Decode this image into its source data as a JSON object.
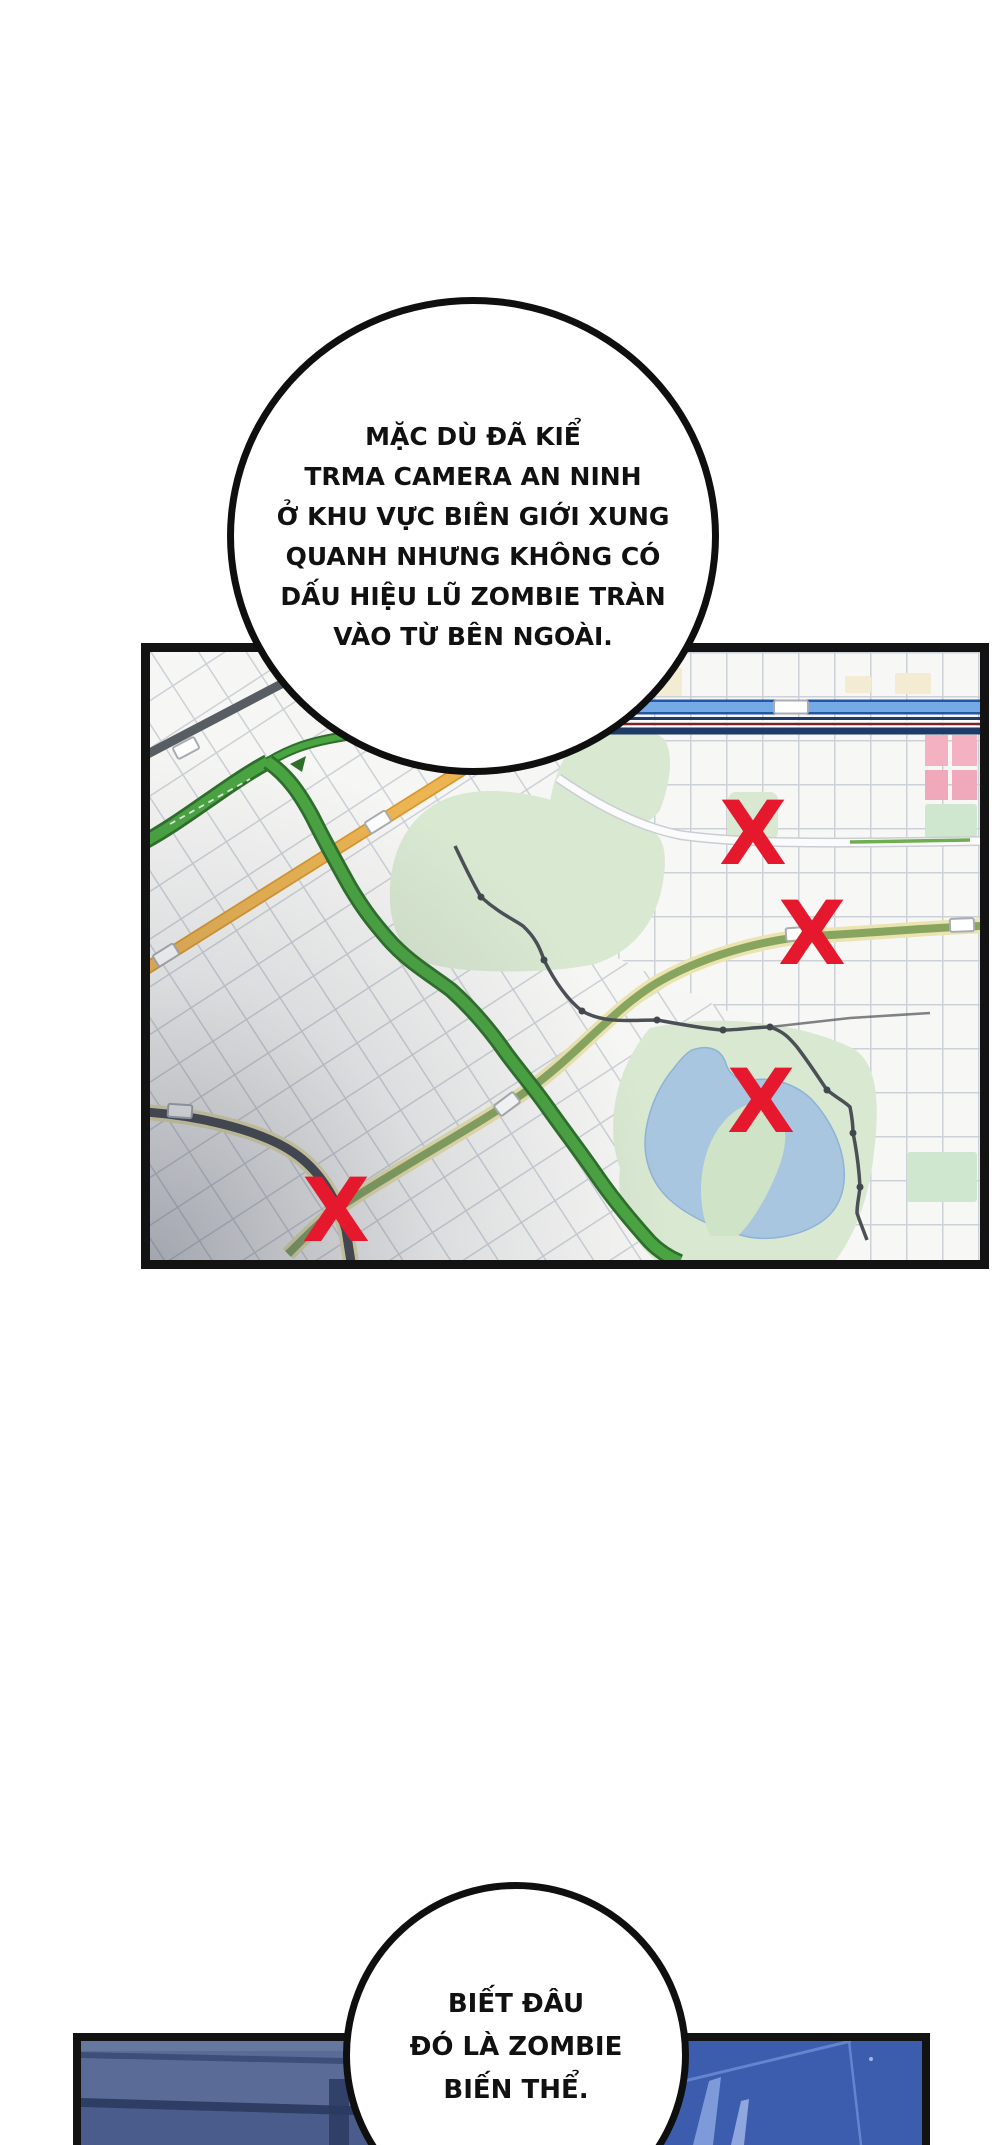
{
  "top_bubble": {
    "lines": [
      "MẶC DÙ ĐÃ KIỂ",
      "TRMA CAMERA AN NINH",
      "Ở KHU VỰC BIÊN GIỚI XUNG",
      "QUANH NHƯNG KHÔNG CÓ",
      "DẤU HIỆU LŨ ZOMBIE TRÀN",
      "VÀO TỪ BÊN NGOÀI."
    ]
  },
  "bottom_bubble": {
    "lines": [
      "BIẾT ĐÂU",
      "ĐÓ LÀ ZOMBIE",
      "BIẾN THỂ."
    ]
  },
  "map_panel": {
    "mark_color": "#e5182d",
    "mark_font_size": "88",
    "marks": [
      {
        "label": "X",
        "x": "603",
        "y": "212"
      },
      {
        "label": "X",
        "x": "662",
        "y": "312"
      },
      {
        "label": "X",
        "x": "611",
        "y": "480"
      },
      {
        "label": "X",
        "x": "186",
        "y": "589"
      }
    ],
    "colors": {
      "background": "#f1f2f0",
      "grid_line": "#ccd1d7",
      "park_green": "#d9e8d1",
      "water_blue": "#a9c6e1",
      "highway_green": "#4aa441",
      "highway_edge": "#2e6f2b",
      "road_orange": "#ecb452",
      "road_cream": "#ebe3b0",
      "road_olive": "#87a55f",
      "road_dark": "#43474e",
      "road_gray": "#585d63",
      "road_blue": "#74abe4",
      "rail_navy": "#1e3a66",
      "block_pink": "#f3b1c1",
      "block_cream": "#f3ecd2",
      "block_green": "#cfe6cf"
    }
  },
  "bottom_panel": {
    "colors": {
      "wall_left": "#5a6b97",
      "wall_right": "#3c5cad",
      "band_dark": "#2e3d63",
      "edge_dark": "#2b3a61",
      "ridge_light": "#6384cf"
    }
  }
}
